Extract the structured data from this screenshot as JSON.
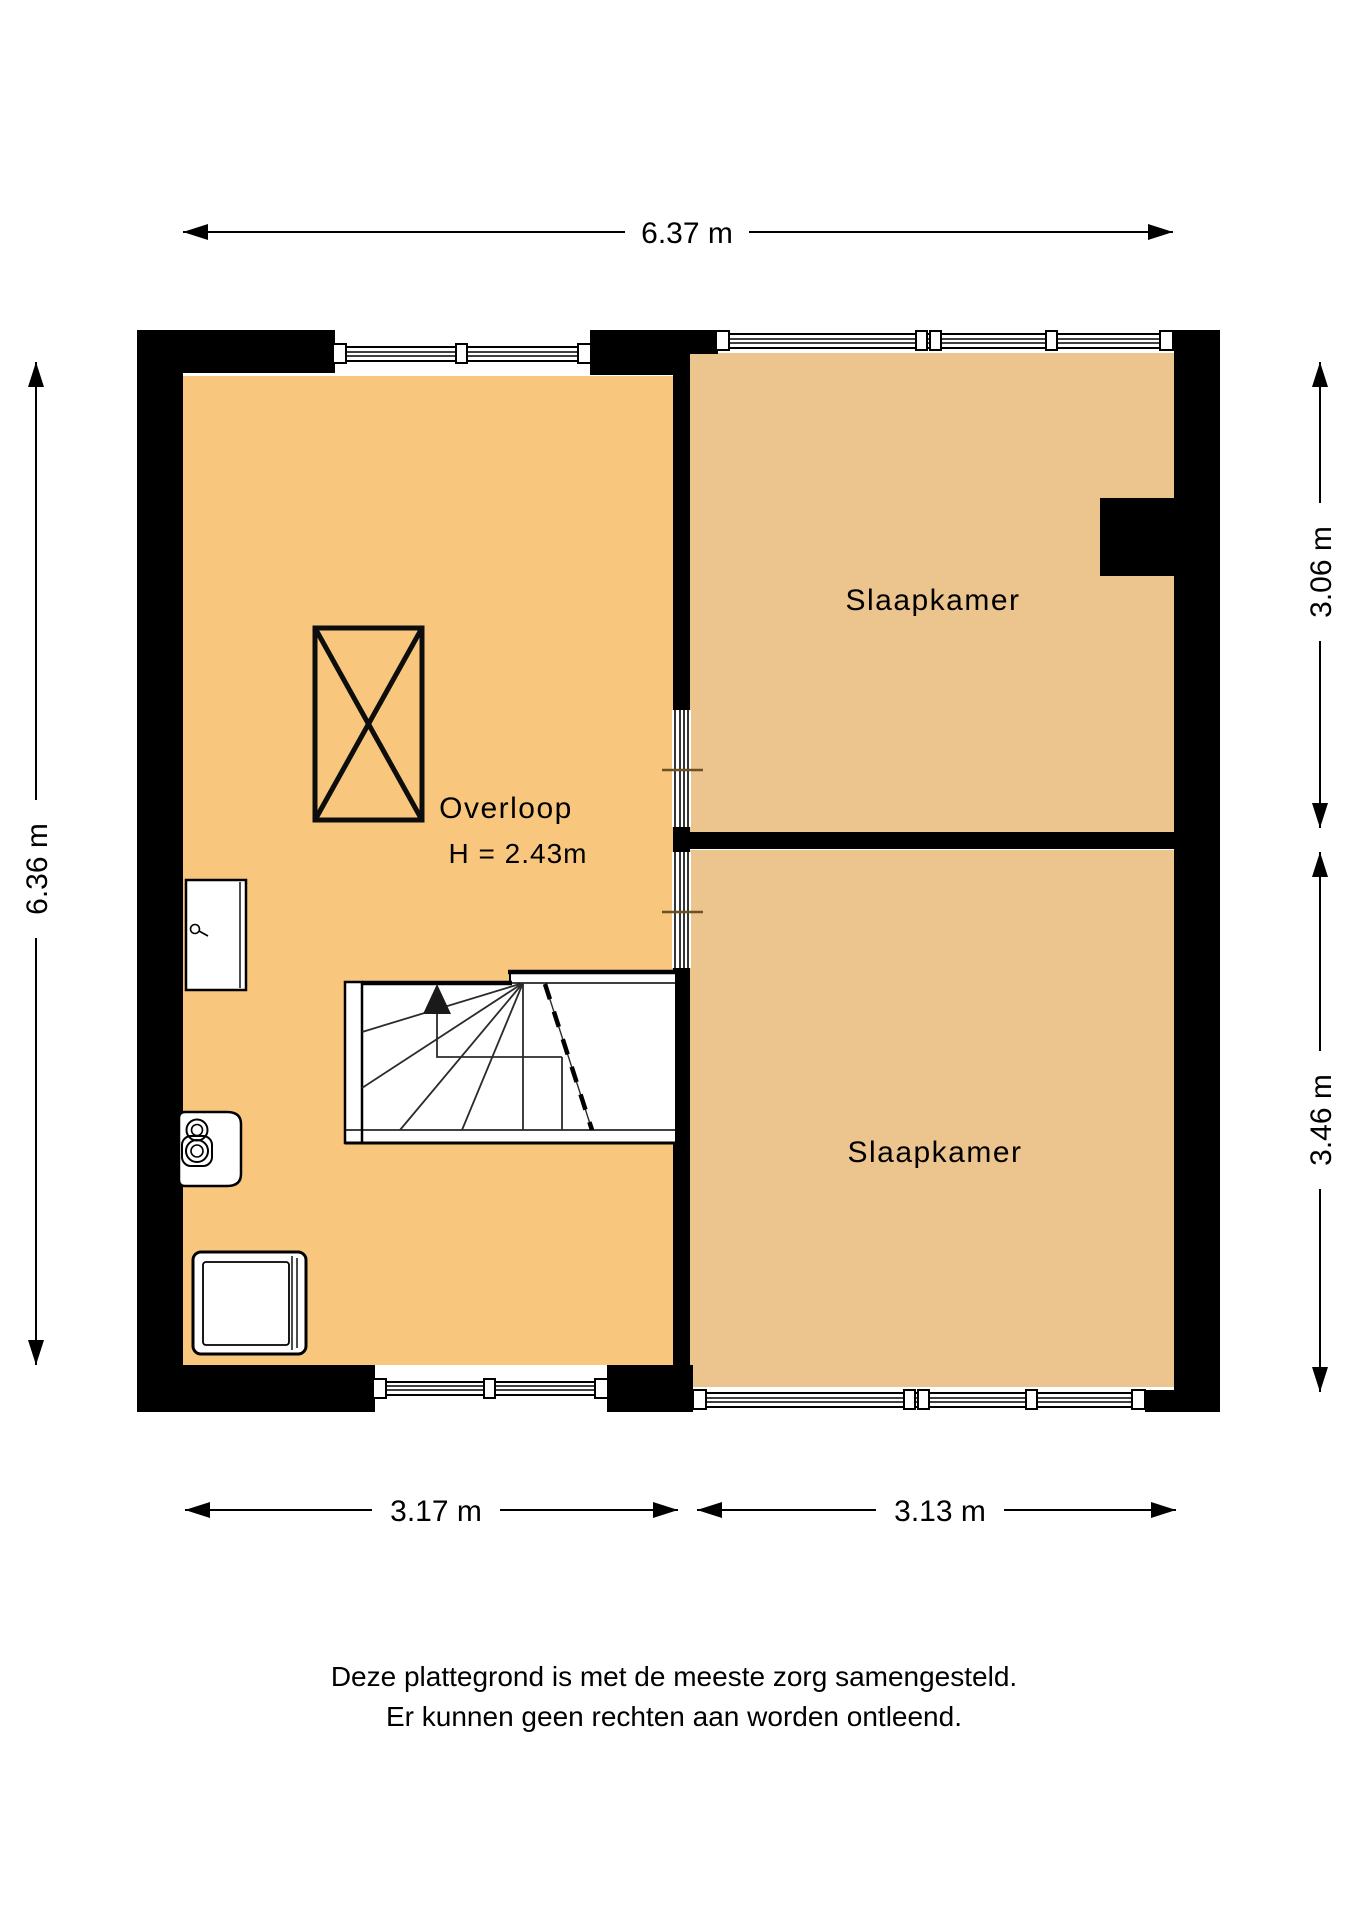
{
  "floorplan": {
    "rooms": {
      "overloop": {
        "label": "Overloop",
        "ceiling_height": "H = 2.43m"
      },
      "bedroom_top": {
        "label": "Slaapkamer"
      },
      "bedroom_bottom": {
        "label": "Slaapkamer"
      }
    },
    "dimensions": {
      "total_width": "6.37 m",
      "left_total_height": "6.36 m",
      "bedroom_top_height": "3.06 m",
      "bedroom_bottom_height": "3.46 m",
      "overloop_width": "3.17 m",
      "bedroom_width": "3.13 m"
    },
    "colors": {
      "overloop_fill": "#F8C77D",
      "bedroom_fill": "#ECC48D",
      "wall": "#000000",
      "door_marker": "#6B5126",
      "background": "#FFFFFF"
    },
    "symbols": {
      "staircase": "winder-staircase-up-arrow",
      "shaft": "crossed-rectangle-shaft",
      "windows": "double-line-window",
      "appliances": [
        "boiler-cabinet",
        "ventilation-unit",
        "washing-machine"
      ]
    },
    "disclaimer": {
      "line1": "Deze plattegrond is met de meeste zorg samengesteld.",
      "line2": "Er kunnen geen rechten aan worden ontleend."
    }
  }
}
